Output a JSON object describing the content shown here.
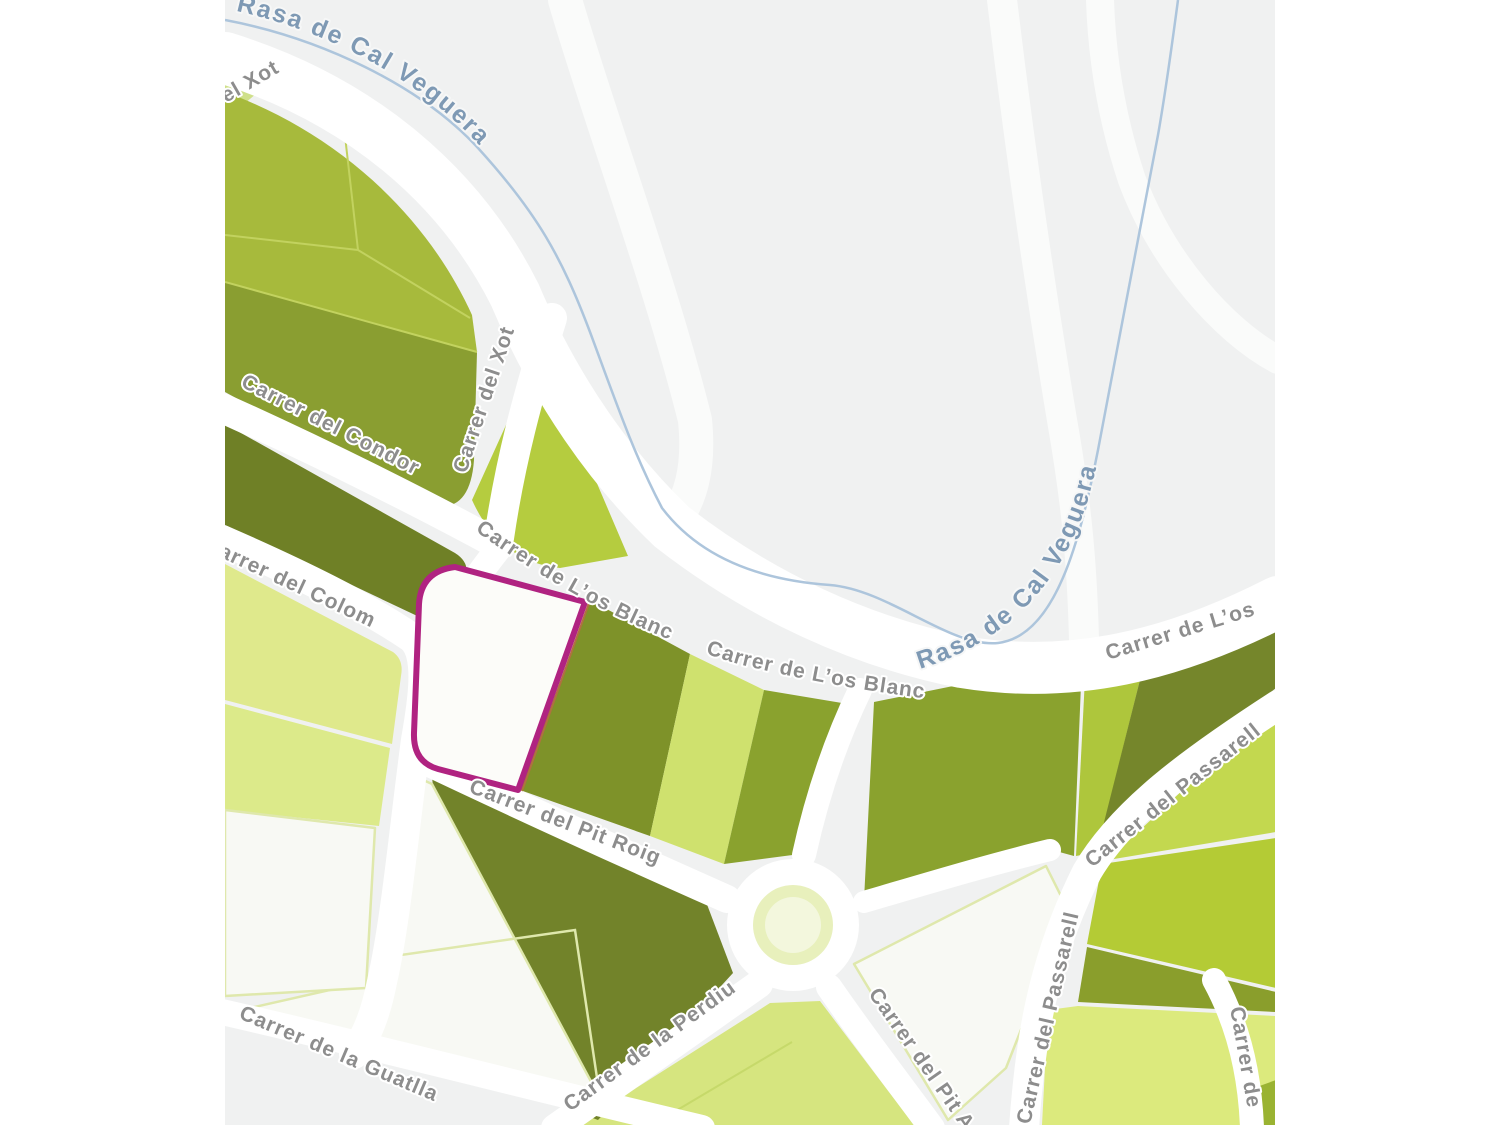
{
  "map": {
    "colors": {
      "canvas_bg": "#f0f1f1",
      "road": "#ffffff",
      "highlight_outline": "#b02381",
      "highlight_fill": "#fcfcf9",
      "stream": "#adc5dc",
      "stream_label": "#7e99b4",
      "street_label": "#8d8d8d",
      "parcel_medium": "#a7ba3c",
      "parcel_medium_dark": "#8a9e31",
      "parcel_dark": "#6f8026",
      "parcel_olive": "#8aa22e",
      "parcel_bright": "#b5cc3f",
      "parcel_light": "#cfe16e",
      "parcel_pale": "#dfe98c",
      "parcel_white": "#f8f9f4"
    },
    "labels": {
      "stream_1": "Rasa de Cal Veguera",
      "stream_2": "Rasa de Cal Veguera",
      "xot_partial": "el Xot",
      "xot": "Carrer del Xot",
      "condor": "Carrer del Condor",
      "colom": "Carrer del Colom",
      "los_blanc_1": "Carrer de L’os Blanc",
      "los_blanc_2": "Carrer de L’os Blanc",
      "los_blanc_3": "Carrer de L’os",
      "pit_roig": "Carrer del Pit Roig",
      "guatlla": "Carrer de la Guatlla",
      "perdiu": "Carrer de la Perdiu",
      "pit_partial": "Carrer del Pit A",
      "passarell_1": "Carrer del Passarell",
      "passarell_2": "Carrer del Passarell",
      "carrer_partial": "Carrer de"
    }
  }
}
